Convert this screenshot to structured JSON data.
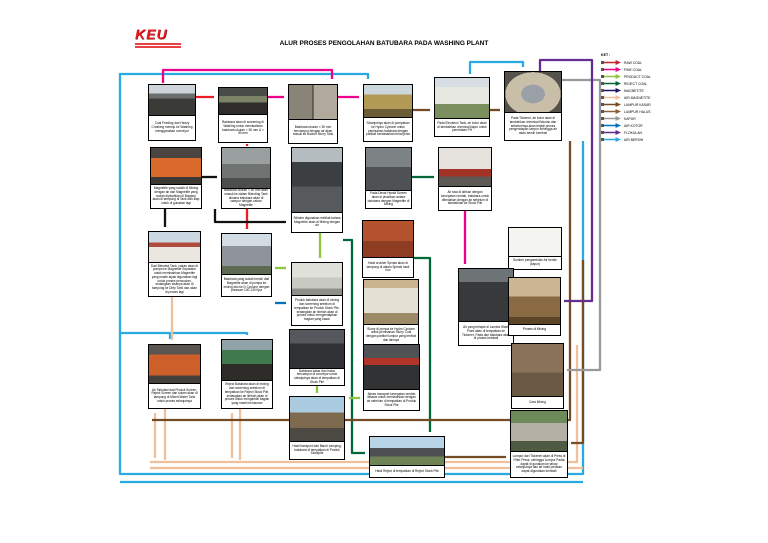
{
  "header": {
    "logo_text": "KEU",
    "title": "ALUR PROSES PENGOLAHAN BATUBARA PADA WASHING PLANT"
  },
  "legend": {
    "heading": "KET :",
    "items": [
      {
        "label": "RAW COAL",
        "color": "#c1272d"
      },
      {
        "label": "FINE COAL",
        "color": "#ec008c"
      },
      {
        "label": "PRODUCT COAL",
        "color": "#8dc63f"
      },
      {
        "label": "REJECT COAL",
        "color": "#006838"
      },
      {
        "label": "MAGNETITE",
        "color": "#1b1464"
      },
      {
        "label": "AIR MAGNETITE",
        "color": "#f0bf9b"
      },
      {
        "label": "LUMPUR KASAR",
        "color": "#754c24"
      },
      {
        "label": "LUMPUR HALUS",
        "color": "#8c6239"
      },
      {
        "label": "KAPUR",
        "color": "#999999"
      },
      {
        "label": "AIR KOTOR",
        "color": "#0072bc"
      },
      {
        "label": "FLOKULAN",
        "color": "#662d91"
      },
      {
        "label": "AIR BERSIH",
        "color": "#29abe2"
      }
    ]
  },
  "boxes": {
    "b1": {
      "caption": "Coal Feeding dari Heavy Crushing menuju ke Washing menggunakan conveyor"
    },
    "b2": {
      "caption": "Batubara akan di screening di Washing untuk memisahkan batubara ukuran > 50 mm & < 50 mm"
    },
    "b3": {
      "caption": "Batubara ukuran < 50 mm bercampur dengan air akan masuk ke Bucket Slurry Tank"
    },
    "b4": {
      "caption": "Selanjutnya akan di pompakan ke Hydro Cyclone untuk pemisahan batubara dengan partikel berdasarkan berat jenis"
    },
    "b5": {
      "caption": "Pada Elevation Tank, air kotor akan di tambahkan chemical kapur untuk penetralan PH"
    },
    "b6": {
      "caption": "Pada Tickener, air kotor akan di tambahkan chemical flokulan dan sebelumnya akan terjadi proses pengendapan lumpur sehingga air akan bersih kembali"
    },
    "b7": {
      "caption": "Magnetite yang sudah di Mixing dengan air dan Magnetite yang sudah dipisahkan di Magsep akan di tampung di Tank dan siap untuk di gunakan lagi"
    },
    "b8": {
      "caption": "Batubara ukuran < 50 mm akan masuk ke dalam Blending Tank dimana batubara akan di campur dengan cairan Magnetite"
    },
    "b9": {
      "caption": "Silinder digunakan melihat bahwa Magnetite akan di Mixing dengan air"
    },
    "b10": {
      "caption": "Pada Desal Hymid Screen akan di pisahkan antara batubara dengan Magnetite di Mixing"
    },
    "b11": {
      "caption": "Air sisa di alirkan dengan kecepatan rendah, batubara untuk dibedakan dengan air sebelum di tambahkan ke Stock Pile"
    },
    "b12": {
      "caption": "Dari Blended Tank, cairan akan di pompa ke Magnetite Separator untuk memisahkan Magnetite yang masih layak digunakan lagi untuk proses pencucian, sedangkan sisanya akan di tampung ke Dirty Tank dan akan di proses lagi"
    },
    "b13": {
      "caption": "Batubara yang sudah bersih dari Magnetite akan di pompa ke mixing lalu ke D Cyclone dengan pressure 100-130 Kpa"
    },
    "b14": {
      "caption": "Sumber pengambilan Air bersih (kapur)"
    },
    "b15": {
      "caption": "Produk batubara akan di mixing dan screening sebelum di tempatkan ke Produk Stock Pile, sedangkan air limbah akan di proses untuk mengendapkan bagian yang kasar"
    },
    "b16": {
      "caption": "Hasil crusher Spirals akan di tampung di dalam Spirals hasil box"
    },
    "b17": {
      "caption": "Slurry di pompa ke Hydro Cyclone untuk pemisahan Slurry Coal dengan partikel lumpur yang terlihat dan lainnya"
    },
    "b18": {
      "caption": "Air yang terlapis di Lamela Wash Plant akan di tempatkan ke Tickener, Pada dan batubara akan di proses kembali"
    },
    "b19": {
      "caption": "Proses di Mixing"
    },
    "b20": {
      "caption": "Air Sirkulasi dari Produk Screen, Reject Screen dan kolam akan di tampung di Mixed Water Tank untuk proses selanjutnya"
    },
    "b21": {
      "caption": "Reject Batubara akan di mixing dan screening sebelum di tempatkan ke Reject Stock Pile, sedangkan air limbah akan di proses untuk mengambil bagian yang masih berukuran"
    },
    "b22": {
      "caption": "Batubara kasar dan halus bercampur di conveyor untuk selanjutnya akan di tempatkan di Stock Pile"
    },
    "b23": {
      "caption": "Akses transport kecepatan rendah dibawa untuk memisahkan dengan air sebelum di tempatkan di Produk Stock Pile"
    },
    "b24": {
      "caption": "Cara Mixing"
    },
    "b25": {
      "caption": "Hasil transport dari Barch camping, batubara di tempatkan di Produk Stockpile"
    },
    "b26": {
      "caption": "Hasil Reject di tempatkan di Reject Stock Pile"
    },
    "b27": {
      "caption": "Lumpur dari Tickener akan di Press di Filter Press, sehingga Lumpur Padat dapat di gunakan ke tahap selanjutnya dan air hasil perasan dapat digunakan kembali"
    }
  }
}
